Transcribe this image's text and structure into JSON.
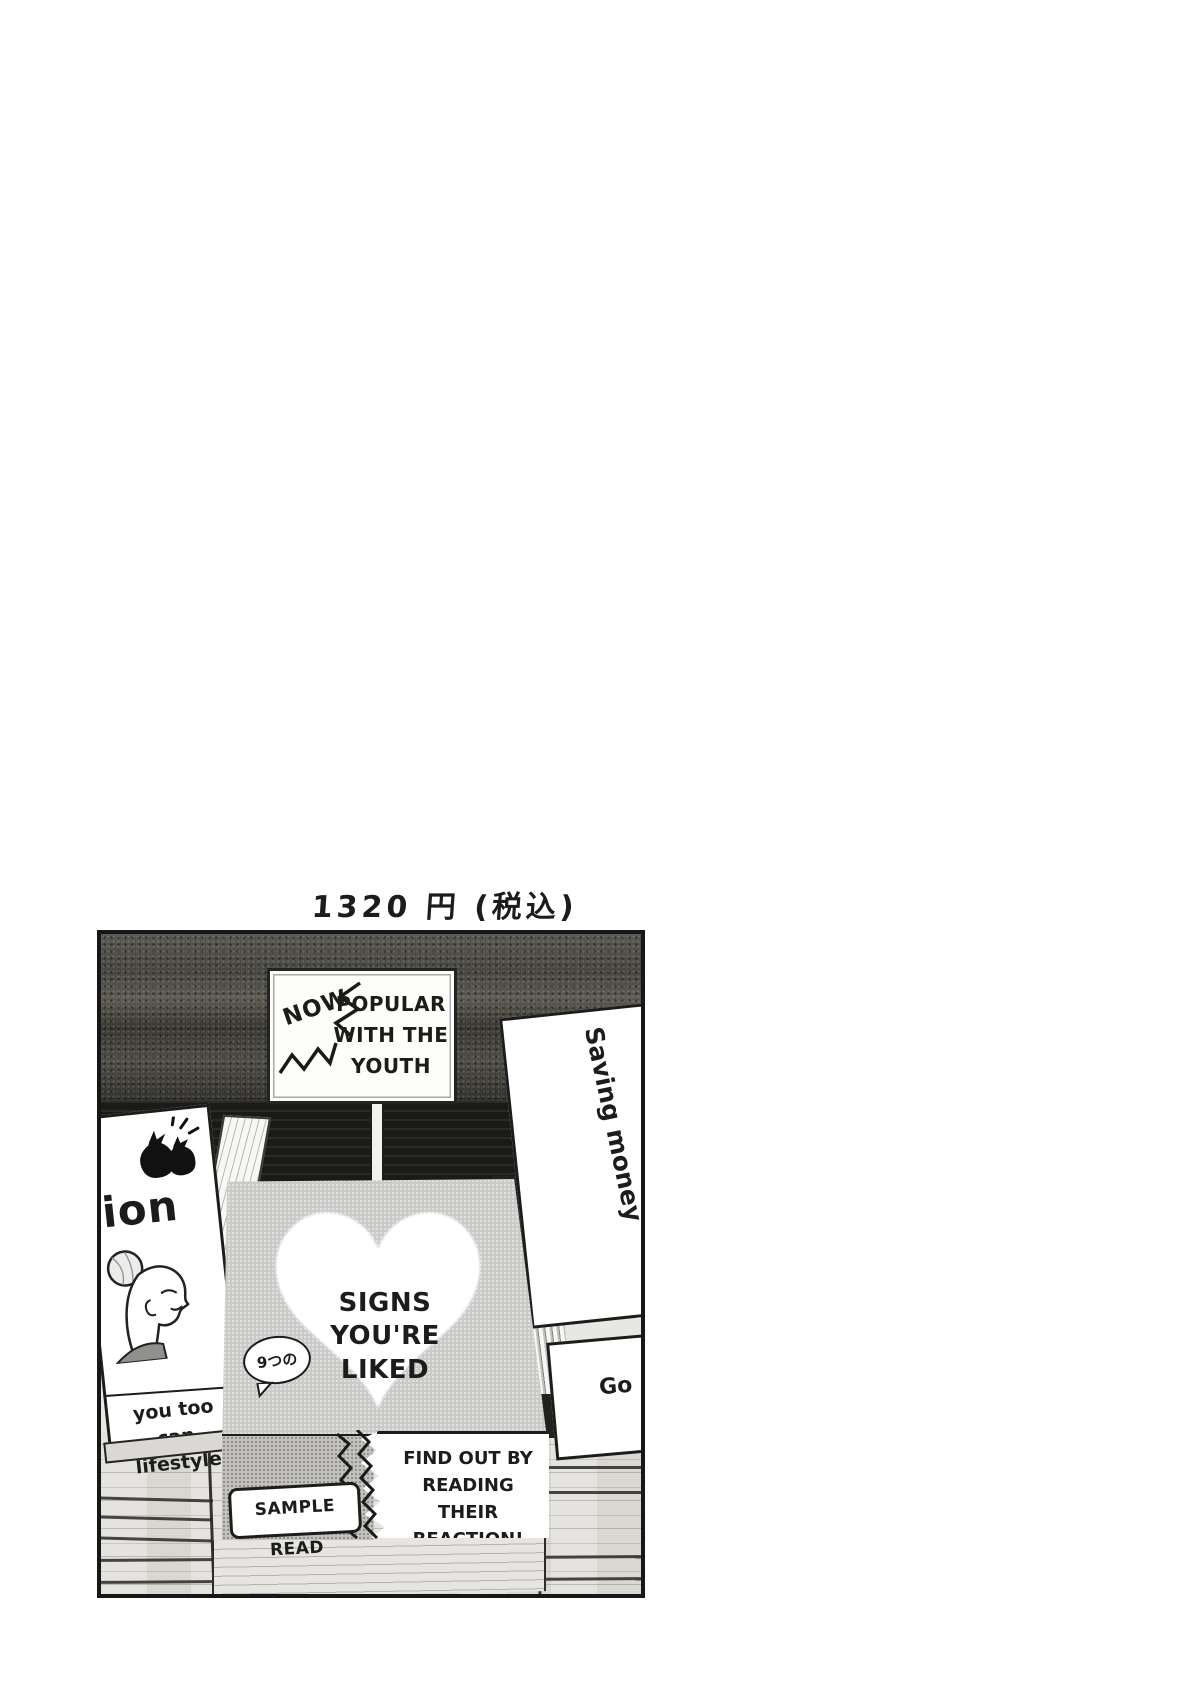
{
  "price_label": "1320 円 (税込)",
  "panel": {
    "signboard": {
      "burst": "NOW",
      "message": "POPULAR\nWITH THE\nYOUTH"
    },
    "left_book": {
      "title_fragment": "tion",
      "tagline": "you too\ncan lifestyle"
    },
    "center_book": {
      "bubble": "9つの",
      "title": "SIGNS\nYOU'RE\nLIKED",
      "obi_text": "FIND OUT BY\nREADING THEIR\nREACTION!"
    },
    "sample_tag_label": "SAMPLE READ",
    "right_stack": {
      "top_book_title": "Saving money",
      "lower_book_title": "Go"
    }
  },
  "icons": {
    "heart-icon": "large white heart on book cover",
    "money-pouch-icon": "black pouch doodle with sparkles",
    "woman-profile-illustration": "woman with hair bun, eyes closed",
    "burst-zigzag-icon": "zigzag emphasis strokes around NOW",
    "bubble-tail-icon": "speech bubble tail",
    "zigzag-divider-icon": "zigzag tear between obi sections"
  },
  "palette": {
    "ink": "#1c1c1a",
    "wall": "#474641",
    "cover_gray": "#cbcac8",
    "wood": "#d9d7d2",
    "paper": "#ffffff"
  }
}
